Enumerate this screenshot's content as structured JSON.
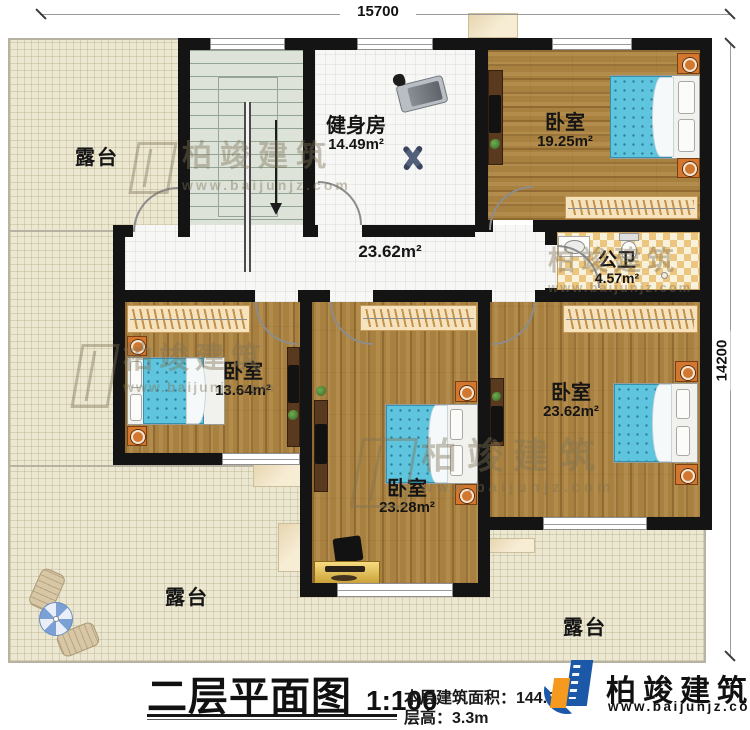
{
  "dimensions": {
    "width_top": "15700",
    "height_right": "14200"
  },
  "rooms": {
    "terrace_top_left": {
      "name": "露台"
    },
    "terrace_bottom_left": {
      "name": "露台"
    },
    "terrace_bottom_right": {
      "name": "露台"
    },
    "gym": {
      "name": "健身房",
      "area": "14.49m²"
    },
    "bedroom_top_right": {
      "name": "卧室",
      "area": "19.25m²"
    },
    "hallway": {
      "area": "23.62m²"
    },
    "bathroom": {
      "name": "公卫",
      "area": "4.57m²"
    },
    "bedroom_left": {
      "name": "卧室",
      "area": "13.64m²"
    },
    "bedroom_middle": {
      "name": "卧室",
      "area": "23.28m²"
    },
    "bedroom_right": {
      "name": "卧室",
      "area": "23.62m²"
    }
  },
  "title_block": {
    "title": "二层平面图",
    "scale": "1:100",
    "floor_area": "本层建筑面积：144.30m²",
    "floor_height": "层高：3.3m"
  },
  "branding": {
    "company": "柏竣建筑",
    "website": "www.baijunjz.com"
  },
  "watermark": {
    "company": "柏竣建筑",
    "website": "www.baijunjz.com"
  },
  "colors": {
    "wall": "#141414",
    "wood_floor": "#a8803f",
    "terrace": "#ebe7d0",
    "bed_mattress": "#5fc4dd",
    "nightstand": "#d2772f",
    "wardrobe": "#f6e3bd",
    "bathroom_tile": "#ecc57e",
    "logo_blue": "#1c58a8",
    "logo_orange": "#f59a1f"
  }
}
